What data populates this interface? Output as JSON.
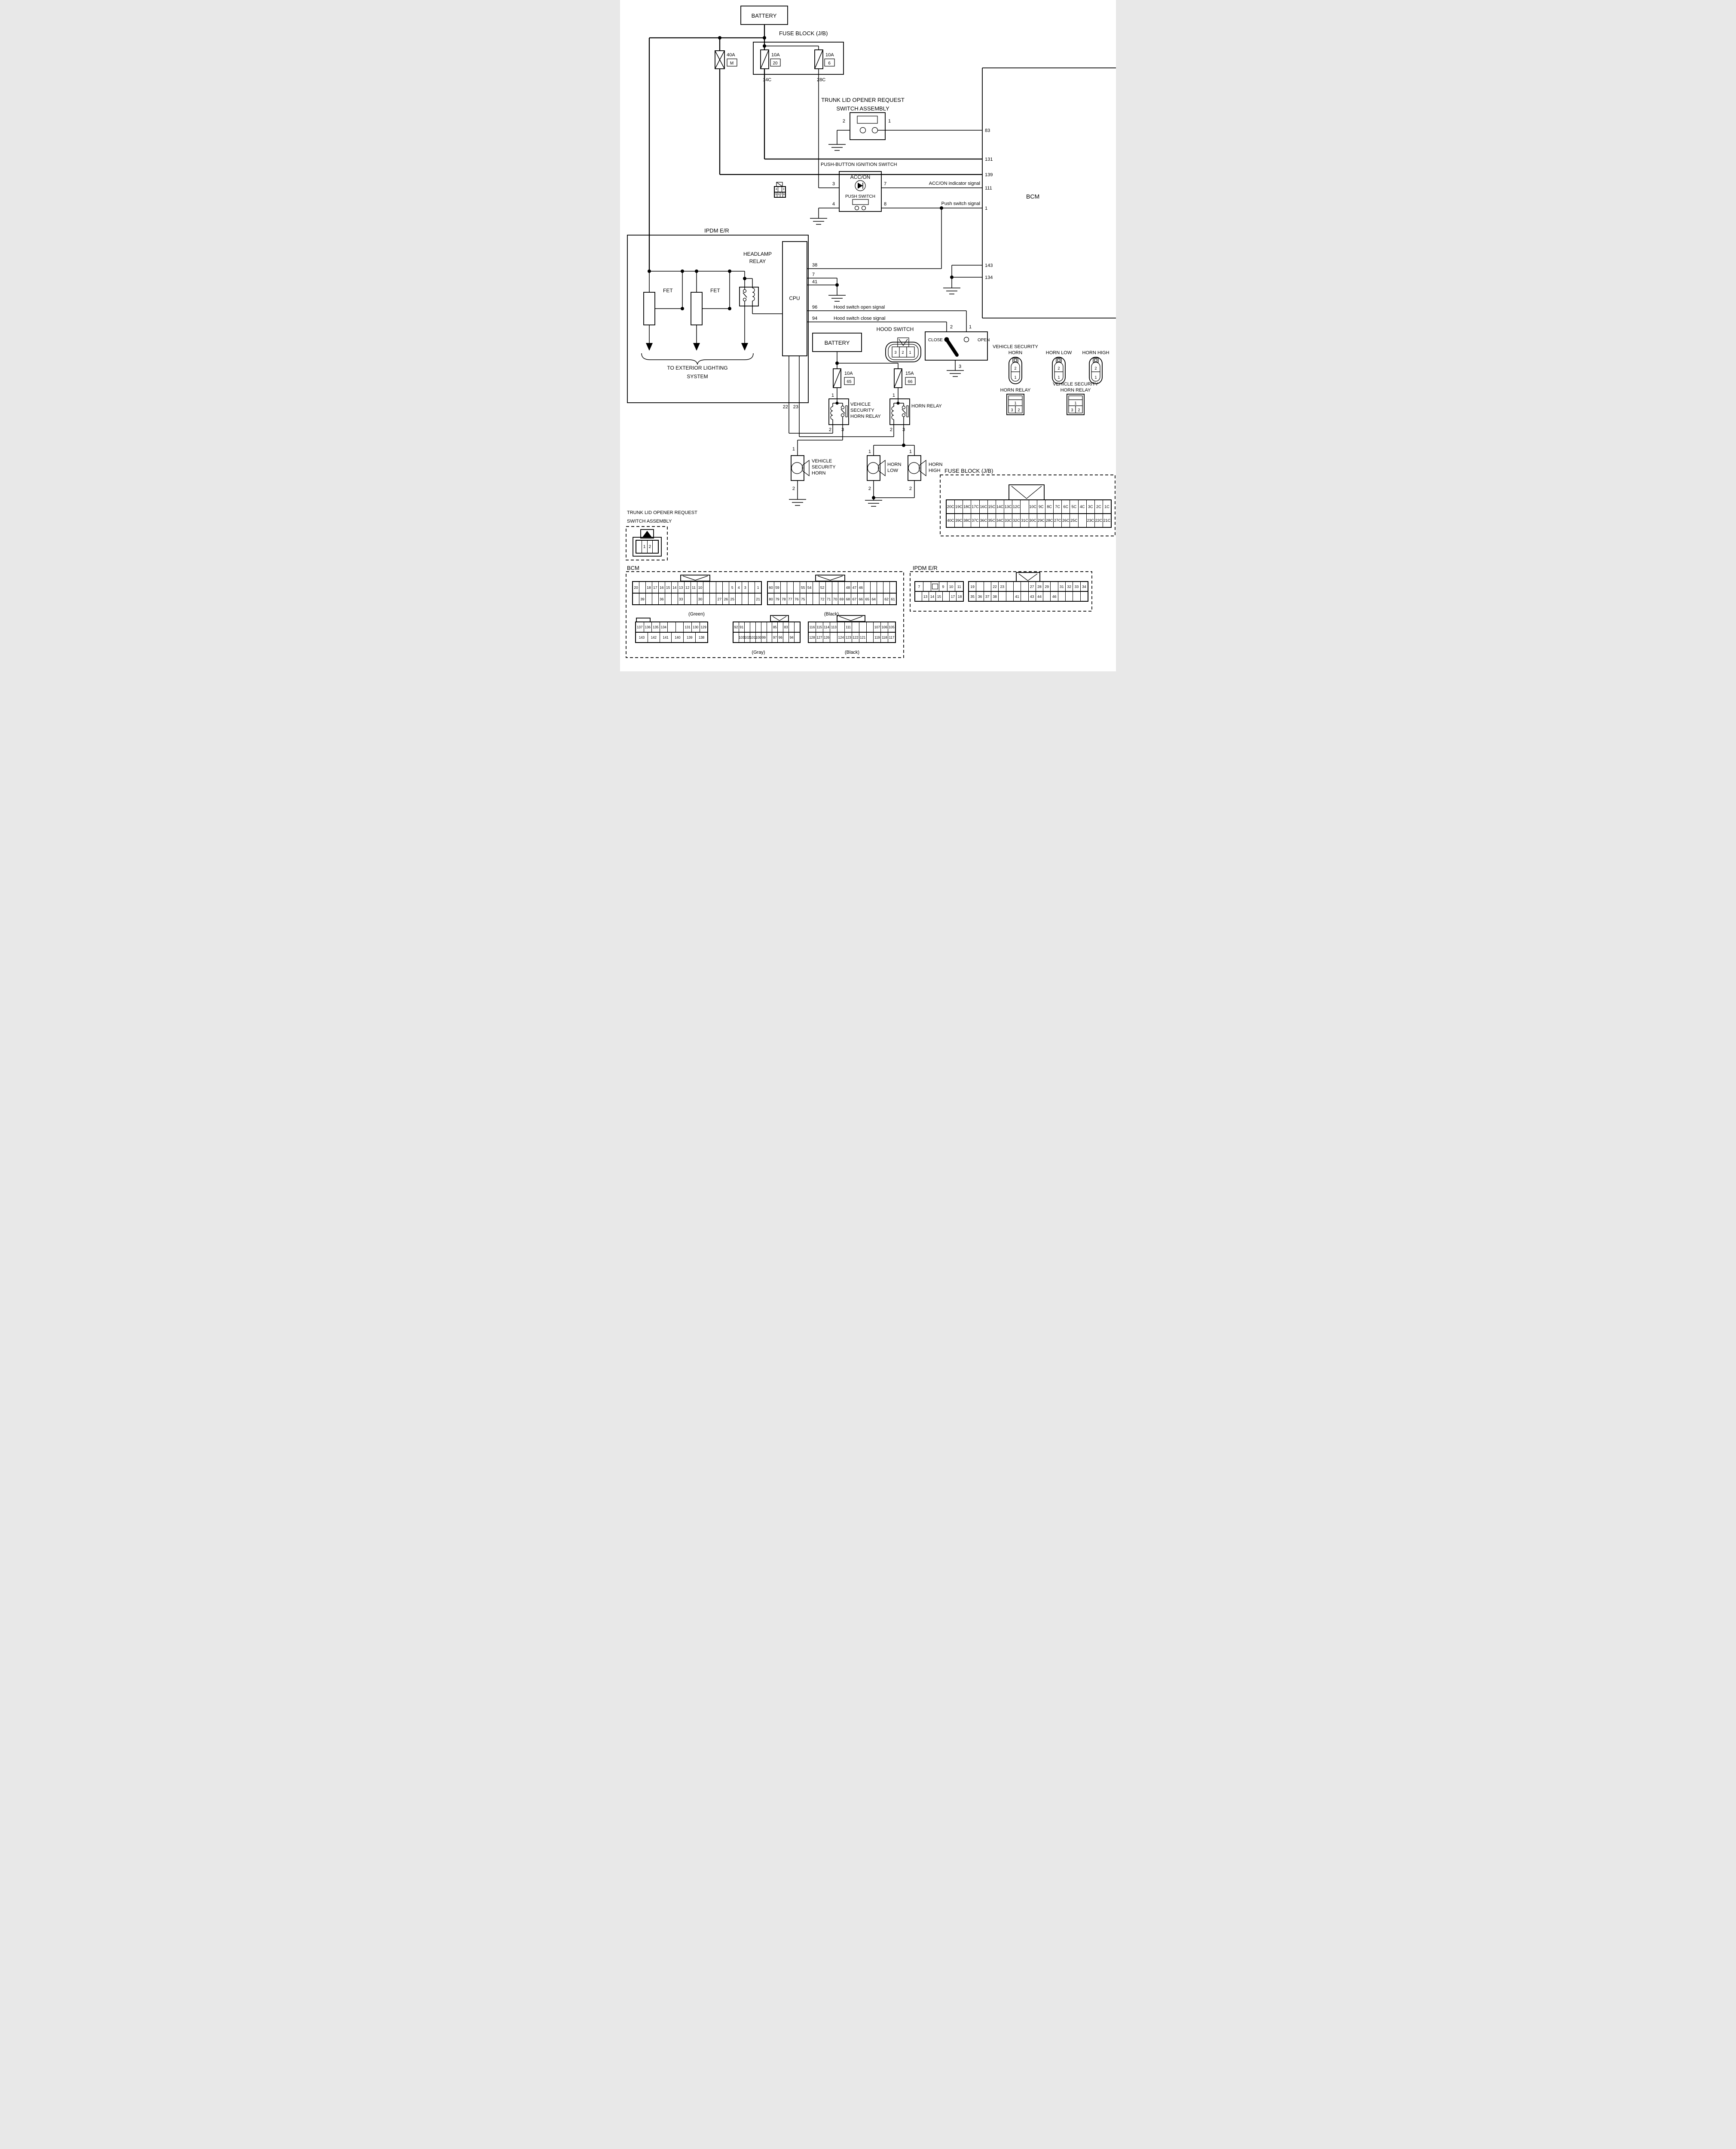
{
  "battery_top": "BATTERY",
  "battery_mid": "BATTERY",
  "fuse_block_jb": {
    "title": "FUSE BLOCK (J/B)",
    "f40": {
      "amp": "40A",
      "id": "M"
    },
    "f20": {
      "amp": "10A",
      "id": "20"
    },
    "f6": {
      "amp": "10A",
      "id": "6"
    },
    "out14c": "14C",
    "out28c": "28C"
  },
  "trunk_switch": {
    "line1": "TRUNK LID OPENER REQUEST",
    "line2": "SWITCH ASSEMBLY",
    "pin1": "1",
    "pin2": "2"
  },
  "push_ignition": {
    "title": "PUSH-BUTTON IGNITION SWITCH",
    "acc_on": "ACC/ON",
    "push_switch": "PUSH SWITCH",
    "pin3": "3",
    "pin4": "4",
    "pin7": "7",
    "pin8": "8",
    "sig_acc": "ACC/ON indicator signal",
    "sig_push": "Push switch signal",
    "connector": {
      "rows": [
        [
          "4",
          "",
          "3"
        ],
        [
          "5",
          "6",
          "7",
          "8"
        ]
      ]
    }
  },
  "bcm": {
    "name": "BCM",
    "p83": "83",
    "p131": "131",
    "p139": "139",
    "p111": "111",
    "p1": "1",
    "p143": "143",
    "p134": "134"
  },
  "ipdm": {
    "name": "IPDM E/R",
    "fet": "FET",
    "headlamp": {
      "l1": "HEADLAMP",
      "l2": "RELAY"
    },
    "cpu": "CPU",
    "p38": "38",
    "p7": "7",
    "p41": "41",
    "p96": "96",
    "p94": "94",
    "p22": "22",
    "p23": "23",
    "ext": {
      "l1": "TO EXTERIOR LIGHTING",
      "l2": "SYSTEM"
    }
  },
  "hood_switch": {
    "title": "HOOD SWITCH",
    "close": "CLOSE",
    "open": "OPEN",
    "pin1": "1",
    "pin2": "2",
    "pin3": "3",
    "sig_open": "Hood switch open signal",
    "sig_close": "Hood switch close signal",
    "connector": {
      "c1": "3",
      "c2": "2",
      "c3": "1"
    }
  },
  "horns": {
    "f65": {
      "amp": "10A",
      "id": "65"
    },
    "f66": {
      "amp": "15A",
      "id": "66"
    },
    "vsh_relay": {
      "l1": "VEHICLE",
      "l2": "SECURITY",
      "l3": "HORN RELAY"
    },
    "horn_relay": "HORN RELAY",
    "pin1": "1",
    "pin2": "2",
    "pin3": "3",
    "vsh": {
      "l1": "VEHICLE",
      "l2": "SECURITY",
      "l3": "HORN"
    },
    "low": {
      "l1": "HORN",
      "l2": "LOW"
    },
    "high": {
      "l1": "HORN",
      "l2": "HIGH"
    }
  },
  "conn_views": {
    "vsh_horn": {
      "l1": "VEHICLE SECURITY",
      "l2": "HORN"
    },
    "horn_low": "HORN LOW",
    "horn_high": "HORN HIGH",
    "horn_relay": "HORN RELAY",
    "vsh_horn_relay": {
      "l1": "VEHICLE SECURITY",
      "l2": "HORN RELAY"
    },
    "cap_pin2": "2",
    "cap_pin1": "1",
    "rly_pin1": "1",
    "rly_pin3": "3",
    "rly_pin2": "2"
  },
  "bottom": {
    "fusejb": {
      "title": "FUSE BLOCK (J/B)",
      "rows": [
        [
          "20C",
          "19C",
          "18C",
          "17C",
          "16C",
          "15C",
          "14C",
          "13C",
          "12C",
          "",
          "10C",
          "9C",
          "8C",
          "7C",
          "6C",
          "5C",
          "4C",
          "3C",
          "2C",
          "1C"
        ],
        [
          "40C",
          "39C",
          "38C",
          "37C",
          "36C",
          "35C",
          "34C",
          "33C",
          "32C",
          "31C",
          "30C",
          "29C",
          "28C",
          "27C",
          "26C",
          "25C",
          "",
          "23C",
          "22C",
          "21C"
        ]
      ]
    },
    "trunk": {
      "line1": "TRUNK LID OPENER REQUEST",
      "line2": "SWITCH ASSEMBLY",
      "rows": [
        [
          "",
          "1",
          "2",
          ""
        ]
      ]
    },
    "bcm_views": {
      "title": "BCM",
      "green": {
        "rows": [
          [
            "20",
            "",
            "18",
            "17",
            "16",
            "15",
            "14",
            "13",
            "12",
            "11",
            "10",
            "",
            "",
            "",
            "",
            "5",
            "4",
            "3",
            "",
            "1"
          ],
          [
            "",
            "39",
            "",
            "",
            "36",
            "",
            "",
            "33",
            "",
            "",
            "30",
            "",
            "",
            "27",
            "26",
            "25",
            "",
            "",
            "",
            "21"
          ]
        ],
        "cap": "(Green)"
      },
      "black": {
        "rows": [
          [
            "60",
            "59",
            "",
            "",
            "",
            "55",
            "54",
            "",
            "52",
            "",
            "",
            "",
            "48",
            "47",
            "46",
            "",
            "",
            "",
            "",
            ""
          ],
          [
            "80",
            "79",
            "78",
            "77",
            "76",
            "75",
            "",
            "",
            "72",
            "71",
            "70",
            "69",
            "68",
            "67",
            "66",
            "65",
            "64",
            "",
            "62",
            "61"
          ]
        ],
        "cap": "(Black)"
      },
      "white": {
        "rows": [
          [
            "137",
            "136",
            "135",
            "134",
            "",
            "",
            "131",
            "130",
            "129"
          ],
          [
            "143",
            "142",
            "141",
            "140",
            "139",
            "138"
          ]
        ]
      },
      "gray": {
        "rows": [
          [
            "92",
            "91",
            "",
            "",
            "",
            "",
            "",
            "85",
            "",
            "83",
            "",
            ""
          ],
          [
            "",
            "103",
            "102",
            "101",
            "100",
            "99",
            "",
            "97",
            "96",
            "",
            "94",
            ""
          ]
        ],
        "cap": "(Gray)"
      },
      "black2": {
        "rows": [
          [
            "116",
            "115",
            "114",
            "113",
            "",
            "111",
            "",
            "",
            "",
            "107",
            "106",
            "105"
          ],
          [
            "128",
            "127",
            "126",
            "",
            "124",
            "123",
            "122",
            "121",
            "",
            "119",
            "118",
            "117"
          ]
        ],
        "cap": "(Black)"
      }
    },
    "ipdm_views": {
      "title": "IPDM E/R",
      "small": {
        "rows": [
          [
            "7",
            "",
            "::rect",
            "9",
            "10",
            "11"
          ],
          [
            "",
            "13",
            "14",
            "15",
            "",
            "17",
            "18"
          ]
        ]
      },
      "large": {
        "rows": [
          [
            "19",
            "",
            "",
            "22",
            "23",
            "",
            "",
            "",
            "27",
            "28",
            "29",
            "",
            "31",
            "32",
            "33",
            "34"
          ],
          [
            "35",
            "36",
            "37",
            "38",
            "",
            "",
            "41",
            "",
            "43",
            "44",
            "",
            "46",
            "",
            "",
            "",
            ""
          ]
        ]
      }
    }
  }
}
